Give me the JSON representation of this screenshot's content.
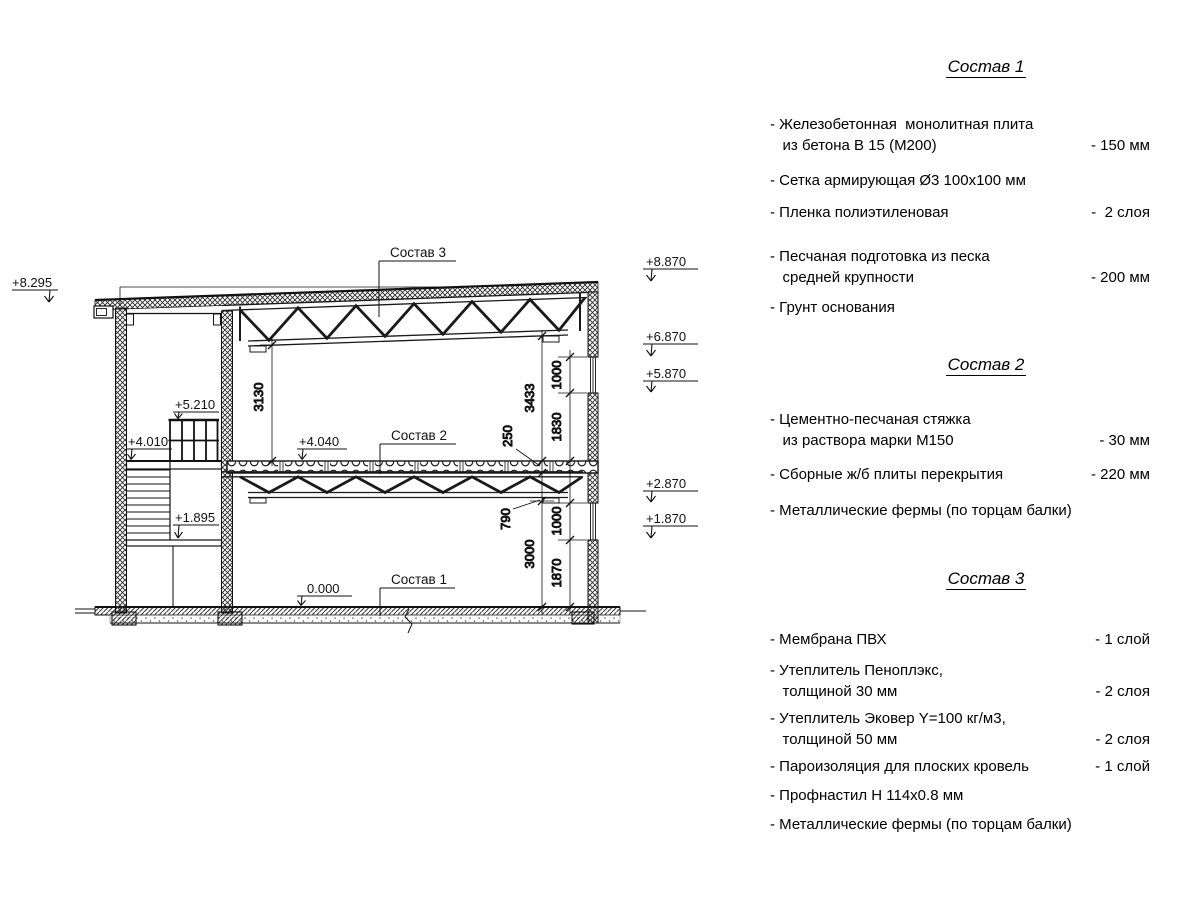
{
  "drawing": {
    "labels": {
      "sostav1": "Состав 1",
      "sostav2": "Состав 2",
      "sostav3": "Состав 3"
    },
    "elevations": {
      "e8295": "+8.295",
      "e8870": "+8.870",
      "e6870": "+6.870",
      "e5870": "+5.870",
      "e2870": "+2.870",
      "e1870": "+1.870",
      "e5210": "+5.210",
      "e4010": "+4.010",
      "e1895": "+1.895",
      "e4040": "+4.040",
      "e0000": "0.000"
    },
    "dims": {
      "d3130": "3130",
      "d3433": "3433",
      "d250": "250",
      "d790": "790",
      "d3000": "3000",
      "d1830": "1830",
      "d1000a": "1000",
      "d1000b": "1000",
      "d1870": "1870"
    }
  },
  "panel": {
    "comp1": {
      "title": "Состав 1",
      "items": [
        {
          "name": "- Железобетонная  монолитная плита\n   из бетона В 15 (М200)",
          "value": "- 150 мм"
        },
        {
          "name": "- Сетка армирующая Ø3 100х100 мм",
          "value": ""
        },
        {
          "name": "- Пленка полиэтиленовая",
          "value": "-  2 слоя"
        },
        {
          "name": "- Песчаная подготовка из песка\n   средней крупности",
          "value": "- 200 мм"
        },
        {
          "name": "- Грунт основания",
          "value": ""
        }
      ]
    },
    "comp2": {
      "title": "Состав 2",
      "items": [
        {
          "name": "- Цементно-песчаная стяжка\n   из раствора марки М150",
          "value": "- 30 мм"
        },
        {
          "name": "- Сборные ж/б плиты перекрытия",
          "value": "- 220 мм"
        },
        {
          "name": "- Металлические фермы (по торцам балки)",
          "value": ""
        }
      ]
    },
    "comp3": {
      "title": "Состав 3",
      "items": [
        {
          "name": "- Мембрана ПВХ",
          "value": "- 1 слой"
        },
        {
          "name": "- Утеплитель Пеноплэкс,\n   толщиной 30 мм",
          "value": "- 2 слоя"
        },
        {
          "name": "- Утеплитель Эковер Y=100 кг/м3,\n   толщиной 50 мм",
          "value": "- 2 слоя"
        },
        {
          "name": "- Пароизоляция для плоских кровель",
          "value": "- 1 слой"
        },
        {
          "name": "- Профнастил Н 114х0.8 мм",
          "value": ""
        },
        {
          "name": "- Металлические фермы (по торцам балки)",
          "value": ""
        }
      ]
    }
  }
}
